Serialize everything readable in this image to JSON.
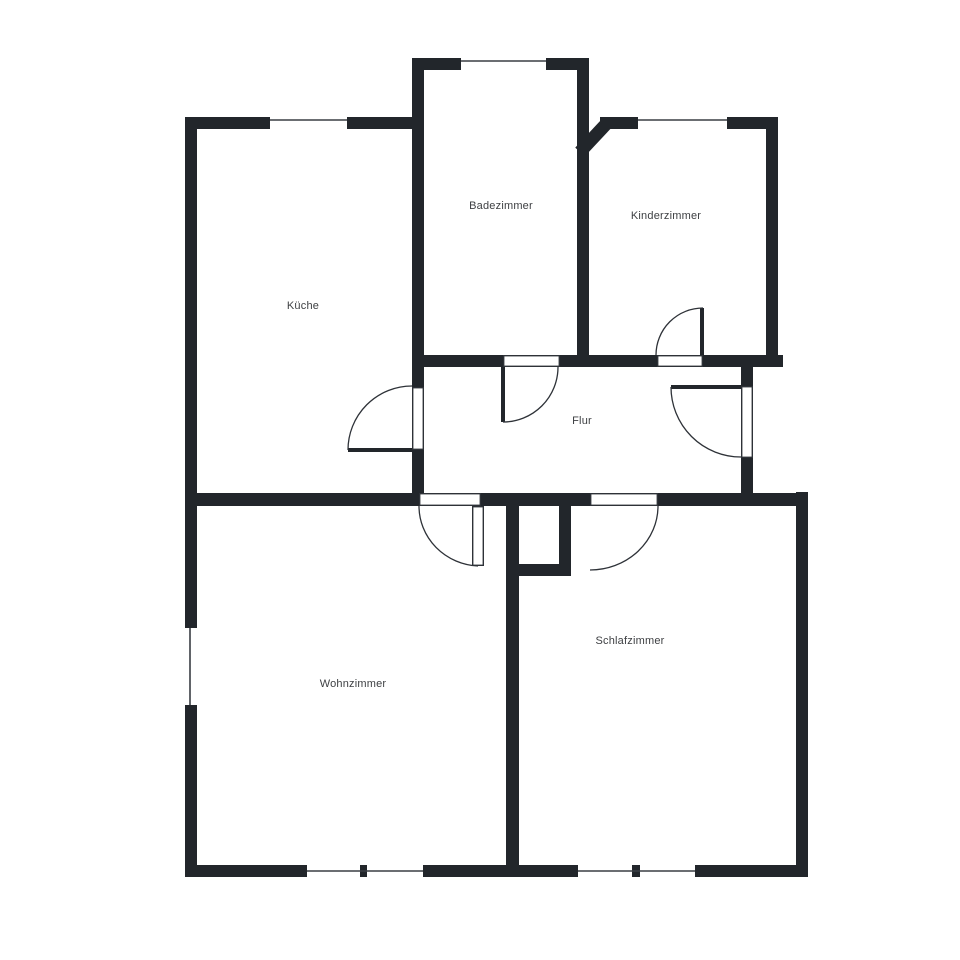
{
  "canvas": {
    "width": 960,
    "height": 960,
    "background": "#ffffff"
  },
  "colors": {
    "wall": "#22262b",
    "line": "#2e3238",
    "glaze": "#3a3e44",
    "text": "#3d3f42",
    "floor": "#ffffff"
  },
  "rooms": [
    {
      "id": "kueche",
      "label": "Küche",
      "cx": 303,
      "cy": 306
    },
    {
      "id": "badezimmer",
      "label": "Badezimmer",
      "cx": 501,
      "cy": 206
    },
    {
      "id": "kinderzimmer",
      "label": "Kinderzimmer",
      "cx": 666,
      "cy": 216
    },
    {
      "id": "flur",
      "label": "Flur",
      "cx": 582,
      "cy": 421
    },
    {
      "id": "wohnzimmer",
      "label": "Wohnzimmer",
      "cx": 353,
      "cy": 684
    },
    {
      "id": "schlafzimmer",
      "label": "Schlafzimmer",
      "cx": 630,
      "cy": 641
    }
  ],
  "plan": {
    "walls": [
      {
        "name": "outer-left-upper",
        "x": 185,
        "y": 117,
        "w": 12,
        "h": 511
      },
      {
        "name": "outer-left-lower",
        "x": 185,
        "y": 705,
        "w": 12,
        "h": 172
      },
      {
        "name": "kueche-flur-divider-upper",
        "x": 412,
        "y": 58,
        "w": 12,
        "h": 329
      },
      {
        "name": "kueche-flur-divider-lower",
        "x": 412,
        "y": 450,
        "w": 12,
        "h": 56
      },
      {
        "name": "bad-kinder-divider",
        "x": 577,
        "y": 58,
        "w": 12,
        "h": 309
      },
      {
        "name": "kinderzimmer-right",
        "x": 766,
        "y": 117,
        "w": 12,
        "h": 250
      },
      {
        "name": "entrance-wall-upper",
        "x": 741,
        "y": 361,
        "w": 12,
        "h": 25
      },
      {
        "name": "entrance-wall-lower",
        "x": 741,
        "y": 458,
        "w": 12,
        "h": 35
      },
      {
        "name": "schlafzimmer-right",
        "x": 796,
        "y": 492,
        "w": 12,
        "h": 385
      },
      {
        "name": "wohn-schlaf-divider",
        "x": 506,
        "y": 506,
        "w": 13,
        "h": 371
      },
      {
        "name": "shaft-right",
        "x": 559,
        "y": 506,
        "w": 12,
        "h": 58
      },
      {
        "name": "shaft-bottom-stub",
        "x": 506,
        "y": 564,
        "w": 65,
        "h": 12
      },
      {
        "name": "bad-top-left",
        "x": 412,
        "y": 58,
        "w": 49,
        "h": 12
      },
      {
        "name": "bad-top-right",
        "x": 546,
        "y": 58,
        "w": 43,
        "h": 12
      },
      {
        "name": "kueche-top-left",
        "x": 185,
        "y": 117,
        "w": 85,
        "h": 12
      },
      {
        "name": "kueche-top-right",
        "x": 347,
        "y": 117,
        "w": 77,
        "h": 12
      },
      {
        "name": "kinder-top-left",
        "x": 600,
        "y": 117,
        "w": 38,
        "h": 12
      },
      {
        "name": "kinder-top-right",
        "x": 727,
        "y": 117,
        "w": 51,
        "h": 12
      },
      {
        "name": "flur-top-left",
        "x": 412,
        "y": 355,
        "w": 91,
        "h": 12
      },
      {
        "name": "flur-top-mid",
        "x": 560,
        "y": 355,
        "w": 97,
        "h": 12
      },
      {
        "name": "flur-top-right",
        "x": 703,
        "y": 355,
        "w": 80,
        "h": 12
      },
      {
        "name": "flur-bottom-left",
        "x": 185,
        "y": 493,
        "w": 234,
        "h": 13
      },
      {
        "name": "flur-bottom-mid",
        "x": 481,
        "y": 493,
        "w": 109,
        "h": 13
      },
      {
        "name": "flur-bottom-right",
        "x": 658,
        "y": 493,
        "w": 150,
        "h": 13
      },
      {
        "name": "bottom-wohn-left",
        "x": 185,
        "y": 865,
        "w": 122,
        "h": 12
      },
      {
        "name": "bottom-wohn-mullion",
        "x": 360,
        "y": 865,
        "w": 7,
        "h": 12
      },
      {
        "name": "bottom-wohn-right",
        "x": 423,
        "y": 865,
        "w": 96,
        "h": 12
      },
      {
        "name": "bottom-schlaf-left",
        "x": 506,
        "y": 865,
        "w": 72,
        "h": 12
      },
      {
        "name": "bottom-schlaf-mullion",
        "x": 632,
        "y": 865,
        "w": 8,
        "h": 12
      },
      {
        "name": "bottom-schlaf-right",
        "x": 695,
        "y": 865,
        "w": 113,
        "h": 12
      }
    ],
    "diagonal_wall": {
      "x1": 580,
      "y1": 152,
      "x2": 608,
      "y2": 122,
      "width": 13
    },
    "window_lines": [
      {
        "name": "kueche-top-window",
        "x1": 270,
        "y1": 120,
        "x2": 347,
        "y2": 120
      },
      {
        "name": "bad-top-window",
        "x1": 461,
        "y1": 61,
        "x2": 546,
        "y2": 61
      },
      {
        "name": "kinder-top-window",
        "x1": 638,
        "y1": 120,
        "x2": 727,
        "y2": 120
      },
      {
        "name": "wohn-left-window",
        "x1": 190,
        "y1": 628,
        "x2": 190,
        "y2": 705
      },
      {
        "name": "wohn-bottom-window",
        "x1": 307,
        "y1": 871,
        "x2": 423,
        "y2": 871
      },
      {
        "name": "schlaf-bottom-window",
        "x1": 578,
        "y1": 871,
        "x2": 695,
        "y2": 871
      }
    ],
    "door_openings": [
      {
        "name": "kueche-door-opening",
        "x": 412,
        "y": 387,
        "w": 12,
        "h": 63
      },
      {
        "name": "bad-door-opening",
        "x": 503,
        "y": 355,
        "w": 57,
        "h": 12
      },
      {
        "name": "kinder-door-opening",
        "x": 657,
        "y": 355,
        "w": 46,
        "h": 12
      },
      {
        "name": "entrance-door-opening",
        "x": 741,
        "y": 386,
        "w": 12,
        "h": 72
      },
      {
        "name": "wohn-door-opening",
        "x": 419,
        "y": 493,
        "w": 62,
        "h": 13
      },
      {
        "name": "schlaf-door-opening",
        "x": 590,
        "y": 493,
        "w": 68,
        "h": 13
      }
    ],
    "door_leaves": [
      {
        "name": "kueche-door-leaf",
        "style": "solid",
        "x": 348,
        "y": 448,
        "w": 64,
        "h": 4
      },
      {
        "name": "bad-door-leaf",
        "style": "solid",
        "x": 501,
        "y": 367,
        "w": 4,
        "h": 55
      },
      {
        "name": "kinder-door-leaf",
        "style": "solid",
        "x": 700,
        "y": 308,
        "w": 4,
        "h": 47
      },
      {
        "name": "entrance-door-leaf",
        "style": "solid",
        "x": 671,
        "y": 385,
        "w": 70,
        "h": 4
      },
      {
        "name": "wohn-door-leaf",
        "style": "outline",
        "x": 472,
        "y": 506,
        "w": 12,
        "h": 60
      }
    ],
    "door_arcs": [
      {
        "name": "kueche-door-arc",
        "d": "M 348 450 A 64 64 0 0 1 412 386"
      },
      {
        "name": "bad-door-arc",
        "d": "M 503 422 A 55 55 0 0 0 558 367"
      },
      {
        "name": "kinder-door-arc",
        "d": "M 703 308 A 47 47 0 0 0 656 355"
      },
      {
        "name": "entrance-door-arc",
        "d": "M 671 387 A 70 70 0 0 0 741 457"
      },
      {
        "name": "wohn-door-arc",
        "d": "M 419 506 A 62 60 0 0 0 478 566"
      },
      {
        "name": "schlaf-door-arc",
        "d": "M 658 506 A 68 64 0 0 1 590 570"
      }
    ]
  }
}
